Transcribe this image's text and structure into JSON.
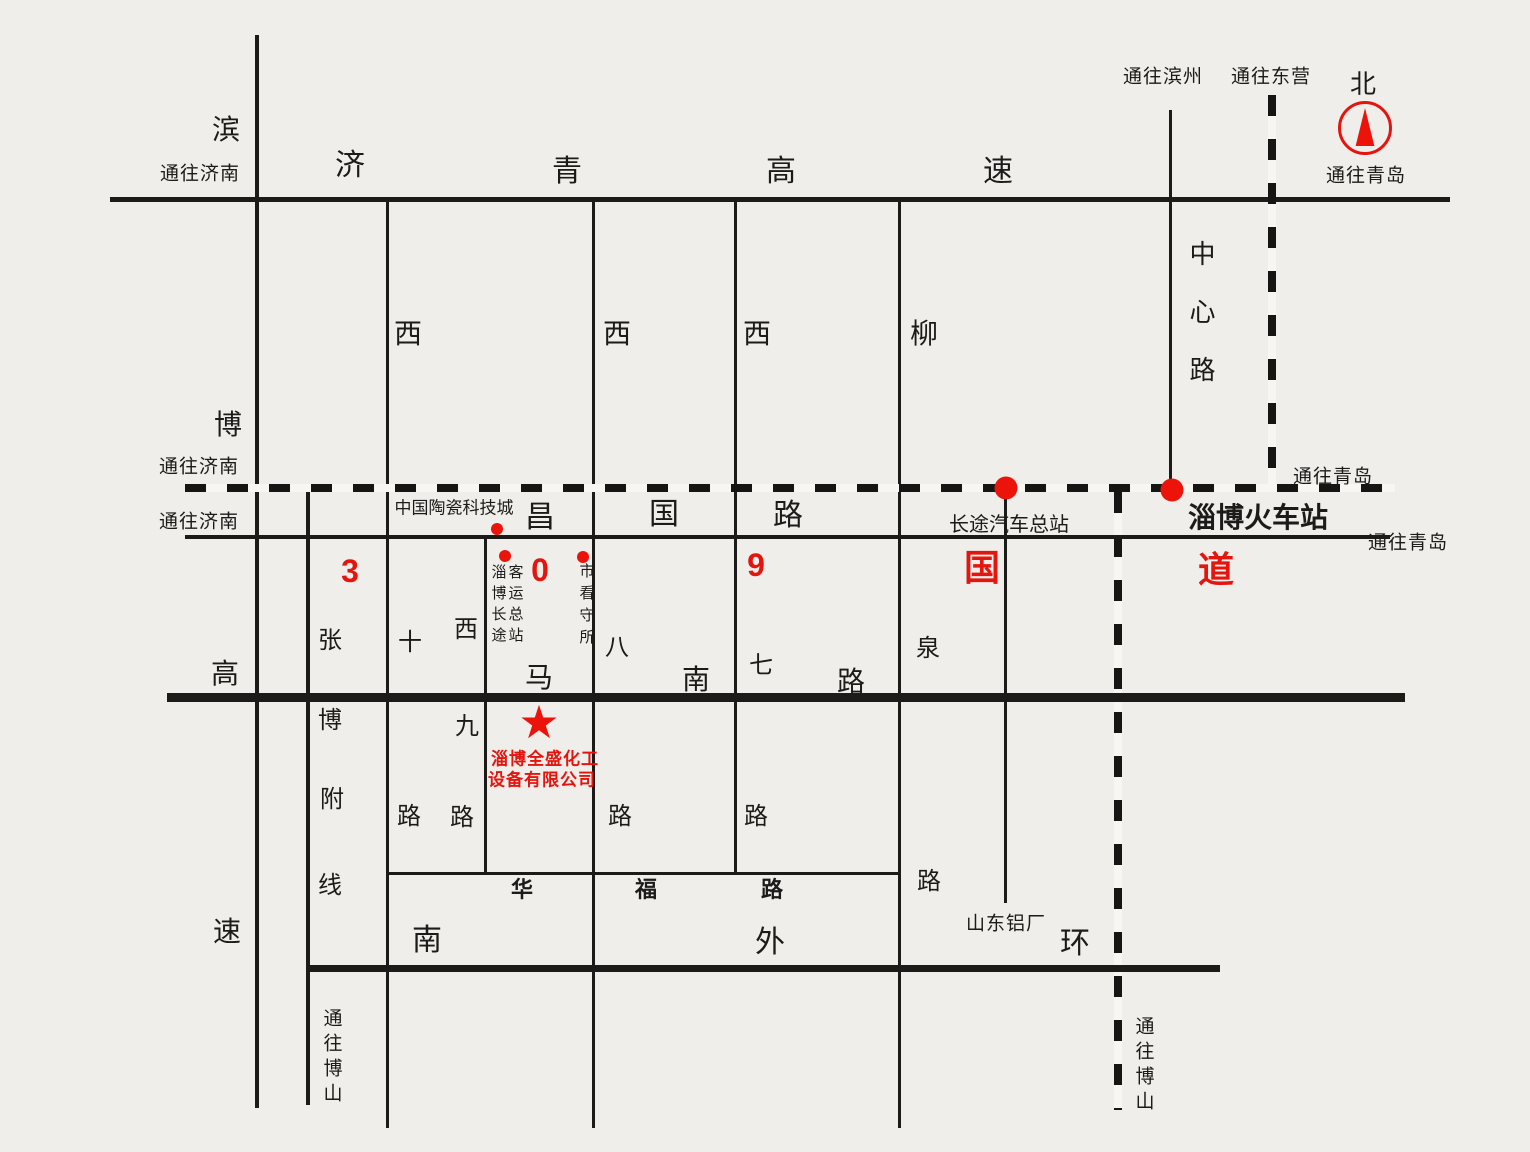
{
  "colors": {
    "red": "#e4150e",
    "ink": "#1d1b19",
    "paper": "#f0eeea"
  },
  "directions": {
    "to_jinan": "通往济南",
    "to_qingdao": "通往青岛",
    "to_binzhou": "通往滨州",
    "to_dongying": "通往东营",
    "to_boshan": "通往博山",
    "north": "北"
  },
  "roads": {
    "jiqing_chars": [
      "济",
      "青",
      "高",
      "速"
    ],
    "binbo_chars": [
      "滨",
      "博",
      "高",
      "速"
    ],
    "zhangbo_chars": [
      "张",
      "博",
      "附",
      "线"
    ],
    "changguo_chars": [
      "昌",
      "国",
      "路"
    ],
    "manan_chars": [
      "马",
      "南",
      "路"
    ],
    "huafu_chars": [
      "华",
      "福",
      "路"
    ],
    "nanwaihuan_chars": [
      "南",
      "外",
      "环"
    ],
    "zhongxin": "中心路",
    "xi10": [
      "西",
      "十",
      "路"
    ],
    "xi9": [
      "西",
      "九",
      "路"
    ],
    "xi8": [
      "西",
      "八",
      "路"
    ],
    "xi7": [
      "西",
      "七",
      "路"
    ],
    "liuquan": [
      "柳",
      "泉",
      "路"
    ]
  },
  "route309": [
    "3",
    "0",
    "9",
    "国",
    "道"
  ],
  "pois": {
    "ceramic_city": "中国陶瓷科技城",
    "bus_terminal_col1": "淄博长途",
    "bus_terminal_col2": "客运总站",
    "detention_house": "市看守所",
    "coach_station": "长途汽车总站",
    "train_station": "淄博火车站",
    "aluminum_plant": "山东铝厂",
    "company_line1": "淄博全盛化工",
    "company_line2": "设备有限公司"
  }
}
